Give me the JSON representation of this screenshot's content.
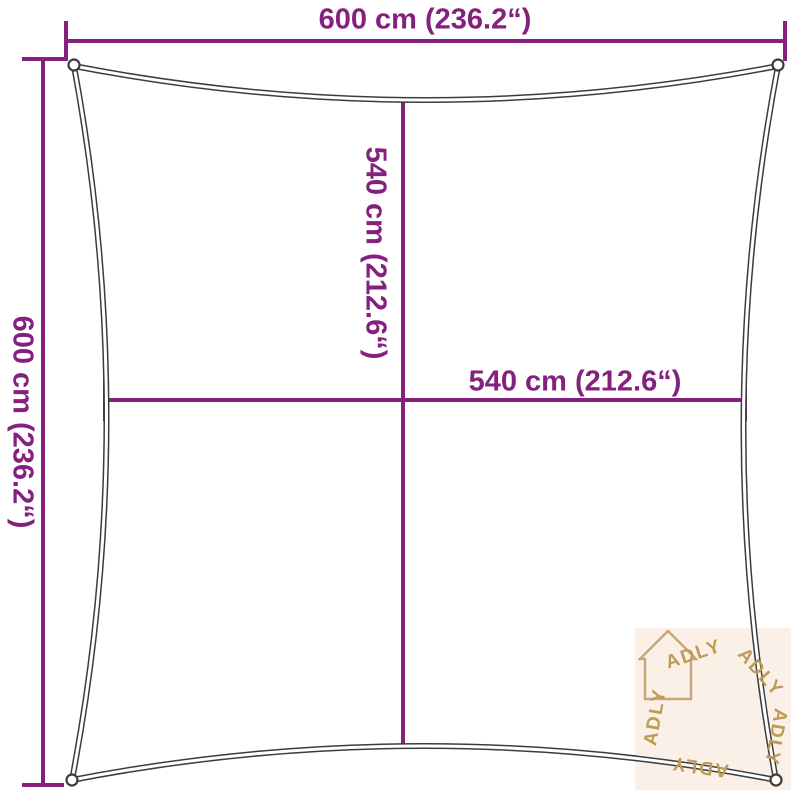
{
  "diagram": {
    "labels": {
      "top_width": "600 cm (236.2“)",
      "left_height": "600 cm (236.2“)",
      "inner_height": "540 cm (212.6“)",
      "inner_width": "540 cm (212.6“)"
    },
    "colors": {
      "dimension": "#84217f",
      "sail_outline": "#3c3c3c"
    }
  },
  "watermark": {
    "brand": "ADLY",
    "colors": {
      "background": "#fbf0e7",
      "text": "#bd9c55",
      "house": "#c9a679"
    }
  }
}
